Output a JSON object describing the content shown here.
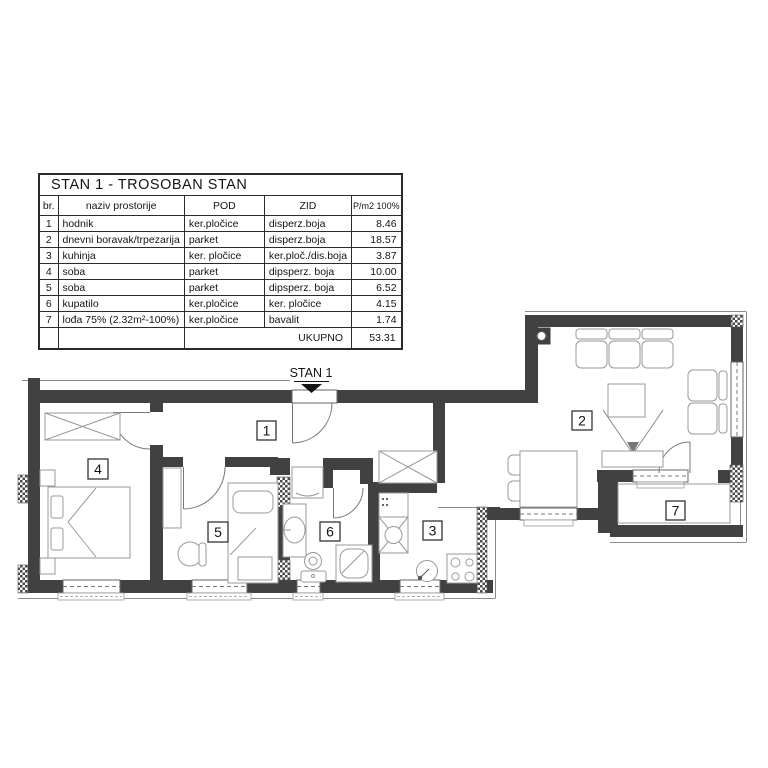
{
  "table": {
    "title": "STAN  1 - TROSOBAN STAN",
    "columns": [
      "br.",
      "naziv prostorije",
      "POD",
      "ZID",
      "P/m2 100%"
    ],
    "rows": [
      {
        "br": "1",
        "naziv": "hodnik",
        "pod": "ker.pločice",
        "zid": "disperz.boja",
        "p": "8.46"
      },
      {
        "br": "2",
        "naziv": "dnevni boravak/trpezarija",
        "pod": "parket",
        "zid": "disperz.boja",
        "p": "18.57"
      },
      {
        "br": "3",
        "naziv": "kuhinja",
        "pod": "ker. pločice",
        "zid": "ker.ploč./dis.boja",
        "p": "3.87"
      },
      {
        "br": "4",
        "naziv": "soba",
        "pod": "parket",
        "zid": "dipsperz. boja",
        "p": "10.00"
      },
      {
        "br": "5",
        "naziv": "soba",
        "pod": "parket",
        "zid": "dipsperz. boja",
        "p": "6.52"
      },
      {
        "br": "6",
        "naziv": "kupatilo",
        "pod": "ker.pločice",
        "zid": "ker. pločice",
        "p": "4.15"
      },
      {
        "br": "7",
        "naziv": "lođa 75%  (2.32m²-100%)",
        "pod": "ker.pločice",
        "zid": "bavalit",
        "p": "1.74"
      }
    ],
    "total_label": "UKUPNO",
    "total_value": "53.31"
  },
  "plan": {
    "entrance_label": "STAN 1",
    "rooms": [
      {
        "number": "1",
        "name": "hodnik"
      },
      {
        "number": "2",
        "name": "dnevni boravak/trpezarija"
      },
      {
        "number": "3",
        "name": "kuhinja"
      },
      {
        "number": "4",
        "name": "soba"
      },
      {
        "number": "5",
        "name": "soba"
      },
      {
        "number": "6",
        "name": "kupatilo"
      },
      {
        "number": "7",
        "name": "lođa"
      }
    ],
    "furniture_icons": [
      "wardrobe-icon",
      "double-bed-icon",
      "single-bed-icon",
      "desk-icon",
      "chair-icon",
      "washing-machine-icon",
      "washbasin-icon",
      "toilet-icon",
      "shower-icon",
      "kitchen-sink-icon",
      "stove-icon",
      "sofa-icon",
      "coffee-table-icon",
      "tv-stand-icon",
      "dining-table-icon",
      "column-icon"
    ]
  },
  "colors": {
    "wall": "#414141",
    "thin_line": "#8a8a8a",
    "furniture": "#999999",
    "text": "#141414"
  }
}
